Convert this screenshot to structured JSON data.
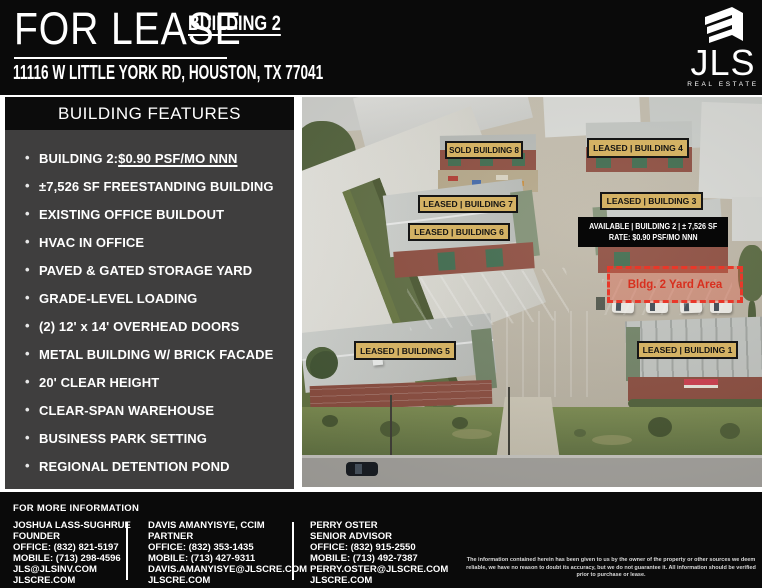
{
  "header": {
    "for_lease": "FOR LEASE",
    "building_tag": "BUILDING 2",
    "address": "11116 W LITTLE YORK RD, HOUSTON, TX 77041",
    "logo": {
      "wordmark": "JLS",
      "tagline": "REAL ESTATE"
    }
  },
  "features": {
    "title": "BUILDING FEATURES",
    "highlight_prefix": "BUILDING 2: ",
    "highlight_rate": "$0.90 PSF/MO NNN",
    "items": [
      "±7,526 SF FREESTANDING BUILDING",
      "EXISTING OFFICE BUILDOUT",
      "HVAC IN OFFICE",
      "PAVED & GATED STORAGE YARD",
      "GRADE-LEVEL LOADING",
      "(2) 12' x 14' OVERHEAD DOORS",
      "METAL BUILDING W/ BRICK FACADE",
      "20' CLEAR HEIGHT",
      "CLEAR-SPAN WAREHOUSE",
      "BUSINESS PARK SETTING",
      "REGIONAL DETENTION POND"
    ]
  },
  "photo": {
    "labels": [
      {
        "text": "SOLD BUILDING 8"
      },
      {
        "text": "LEASED | BUILDING 4"
      },
      {
        "text": "LEASED | BUILDING 7"
      },
      {
        "text": "LEASED | BUILDING 6"
      },
      {
        "text": "LEASED | BUILDING 3"
      },
      {
        "text": "LEASED | BUILDING 5"
      },
      {
        "text": "LEASED | BUILDING 1"
      }
    ],
    "available": {
      "line1": "AVAILABLE | BUILDING 2 | ± 7,526 SF",
      "line2": "RATE: $0.90 PSF/MO NNN"
    },
    "yard_label": "Bldg. 2 Yard Area"
  },
  "footer": {
    "heading": "FOR MORE INFORMATION",
    "contacts": [
      {
        "name": "JOSHUA LASS-SUGHRUE",
        "title": "FOUNDER",
        "office": "OFFICE: (832) 821-5197",
        "mobile": "MOBILE: (713) 298-4596",
        "email": "JLS@JLSINV.COM",
        "website": "JLSCRE.COM"
      },
      {
        "name": "DAVIS AMANYISYE, CCIM",
        "title": "PARTNER",
        "office": "OFFICE: (832) 353-1435",
        "mobile": "MOBILE: (713) 427-9311",
        "email": "DAVIS.AMANYISYE@JLSCRE.COM",
        "website": "JLSCRE.COM"
      },
      {
        "name": "PERRY OSTER",
        "title": "SENIOR ADVISOR",
        "office": "OFFICE: (832) 915-2550",
        "mobile": "MOBILE: (713) 492-7387",
        "email": "PERRY.OSTER@JLSCRE.COM",
        "website": "JLSCRE.COM"
      }
    ],
    "disclaimer": "The information contained herein has been given to us by the owner of the property or other sources we deem reliable, we have no reason to doubt its accuracy, but we do not guarantee it. All information should be verified prior to purchase or lease."
  },
  "colors": {
    "label_gold": "#d4b264",
    "alert_red": "#e8382a",
    "panel_gray": "#3f3e3e",
    "background_black": "#0a0a0a"
  }
}
